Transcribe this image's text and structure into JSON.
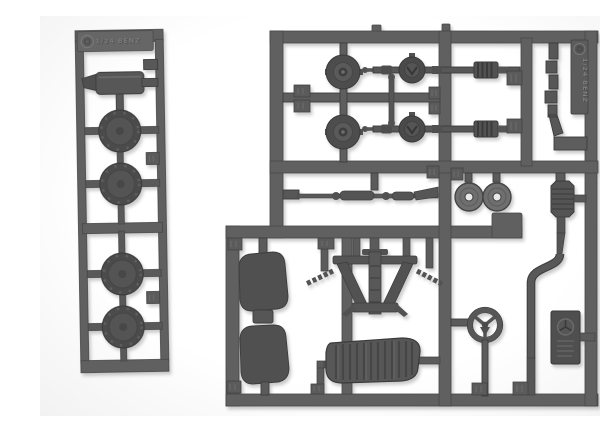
{
  "image": {
    "description": "Photo of two gray injection-molded plastic model kit sprues with 1/24 scale car parts on a white background",
    "background_color": "#fbfbfb",
    "plastic_color": "#5d5d5d",
    "plastic_dark": "#454545",
    "plastic_light": "#7a7a7a"
  },
  "sprues": {
    "left": {
      "name": "narrow wheel sprue",
      "embossed_plate": "1/24 BENZ",
      "logo": "circled-maker-logo",
      "parts": [
        "muffler",
        "intake-scoop",
        "tire",
        "tire",
        "tire",
        "tire"
      ],
      "part_tab_count": 2
    },
    "right": {
      "name": "main chassis sprue",
      "embossed_plate": "1/24 BENZ",
      "logo": "circled-maker-logo",
      "parts": [
        "brake-drum",
        "brake-drum",
        "rear-axle-differential",
        "rear-axle-differential",
        "link-rod",
        "coil-spring",
        "coil-spring",
        "exhaust-header-pipe",
        "tie-rod",
        "brake-disc",
        "brake-disc",
        "seat",
        "seat",
        "front-suspension-frame",
        "fuel-tank",
        "steering-wheel",
        "exhaust-muffler-tailpipe",
        "dashboard-plate"
      ],
      "part_tab_count": 14
    }
  }
}
